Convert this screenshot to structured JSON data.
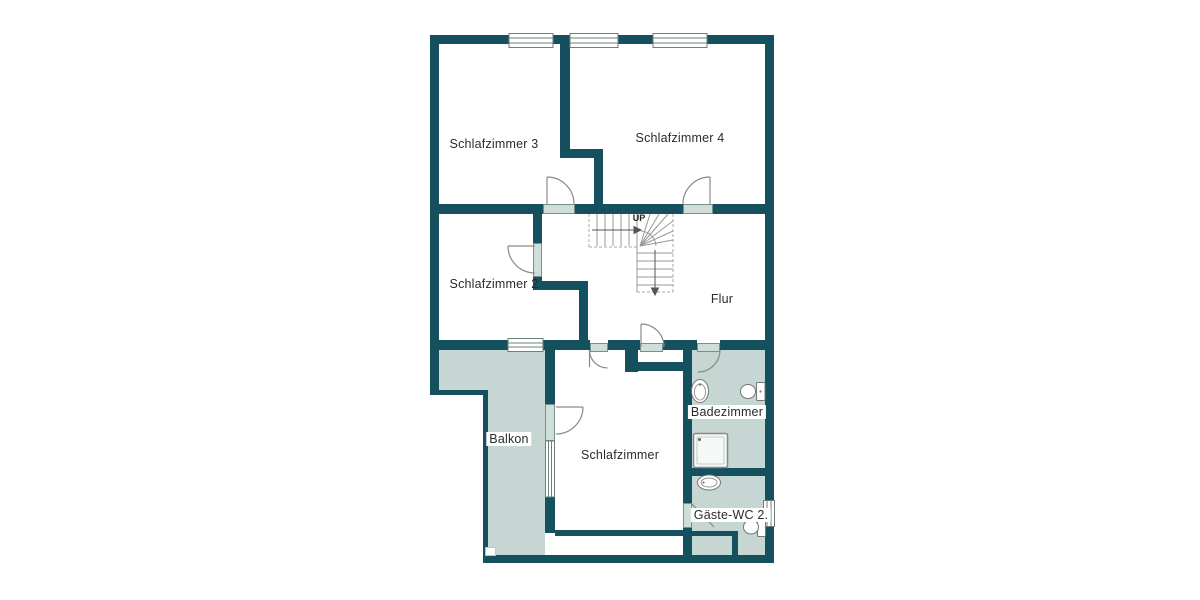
{
  "plan": {
    "type": "floor-plan",
    "rooms": {
      "schlafzimmer3": {
        "label": "Schlafzimmer 3"
      },
      "schlafzimmer4": {
        "label": "Schlafzimmer 4"
      },
      "schlafzimmer2": {
        "label": "Schlafzimmer 2"
      },
      "flur": {
        "label": "Flur"
      },
      "balkon": {
        "label": "Balkon"
      },
      "schlafzimmer": {
        "label": "Schlafzimmer"
      },
      "badezimmer": {
        "label": "Badezimmer"
      },
      "gaeste_wc": {
        "label": "Gäste-WC 2."
      }
    },
    "stairs": {
      "up_label": "UP"
    },
    "fixtures": {
      "badezimmer": [
        "washbasin",
        "toilet",
        "shower"
      ],
      "gaeste_wc": [
        "washbasin",
        "toilet"
      ]
    },
    "colors": {
      "wall": "#15505e",
      "area_fill": "#c6d6d2",
      "door_leaf": "#cfdeda",
      "line": "#8a8a8a",
      "background": "#ffffff"
    }
  }
}
